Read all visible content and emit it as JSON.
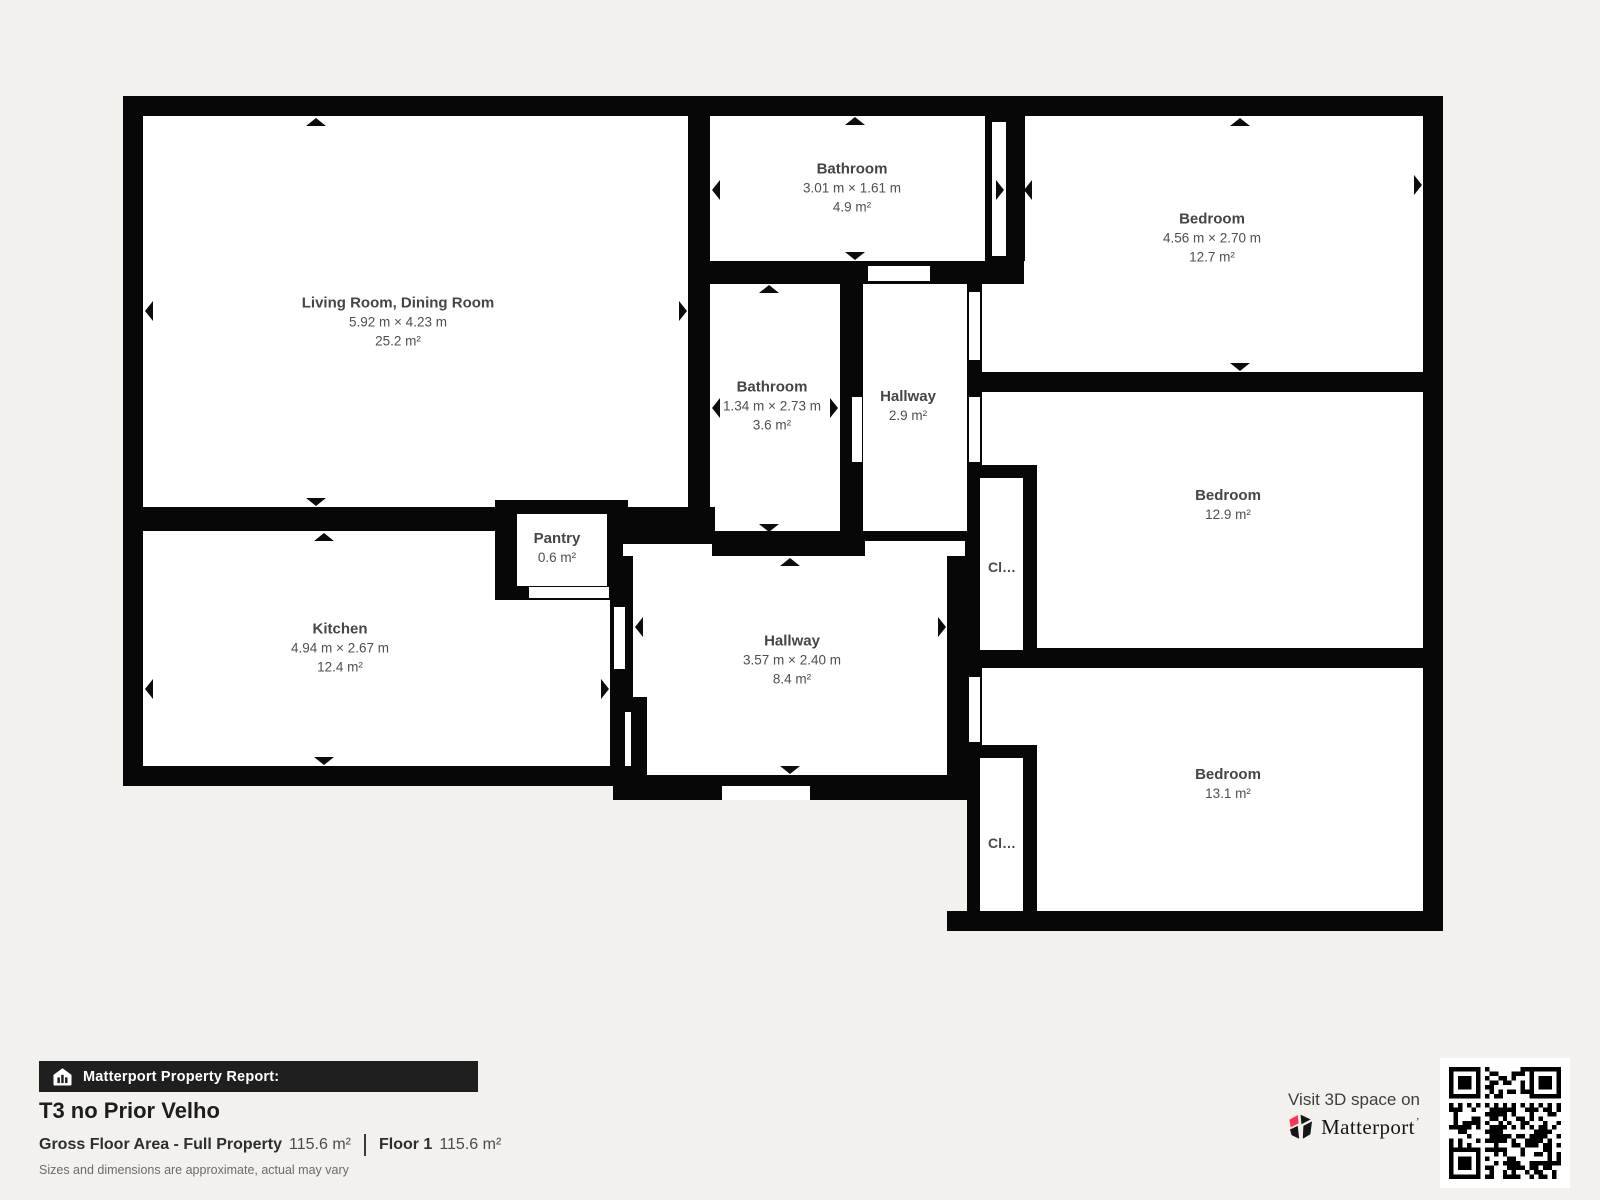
{
  "floor_plan": {
    "rooms": [
      {
        "name": "Living Room, Dining Room",
        "dims": "5.92 m × 4.23 m",
        "area": "25.2 m²"
      },
      {
        "name": "Kitchen",
        "dims": "4.94 m × 2.67 m",
        "area": "12.4 m²"
      },
      {
        "name": "Pantry",
        "area": "0.6 m²"
      },
      {
        "name": "Bathroom",
        "dims": "3.01 m × 1.61 m",
        "area": "4.9 m²"
      },
      {
        "name": "Bathroom",
        "dims": "1.34 m × 2.73 m",
        "area": "3.6 m²"
      },
      {
        "name": "Hallway",
        "area": "2.9 m²"
      },
      {
        "name": "Hallway",
        "dims": "3.57 m × 2.40 m",
        "area": "8.4 m²"
      },
      {
        "name": "Bedroom",
        "dims": "4.56 m × 2.70 m",
        "area": "12.7 m²"
      },
      {
        "name": "Bedroom",
        "area": "12.9 m²"
      },
      {
        "name": "Bedroom",
        "area": "13.1 m²"
      },
      {
        "name": "Cl…"
      },
      {
        "name": "Cl…"
      }
    ]
  },
  "report": {
    "bar_label": "Matterport Property Report:",
    "property_name": "T3 no Prior Velho",
    "gross_label": "Gross Floor Area - Full Property",
    "gross_value": "115.6 m²",
    "floor_label": "Floor 1",
    "floor_value": "115.6 m²",
    "disclaimer": "Sizes and dimensions are approximate, actual may vary"
  },
  "promo": {
    "visit_text": "Visit 3D space on",
    "brand": "Matterport",
    "tick": "’",
    "brand_red": "#ff3158",
    "wall_color": "#070707"
  }
}
